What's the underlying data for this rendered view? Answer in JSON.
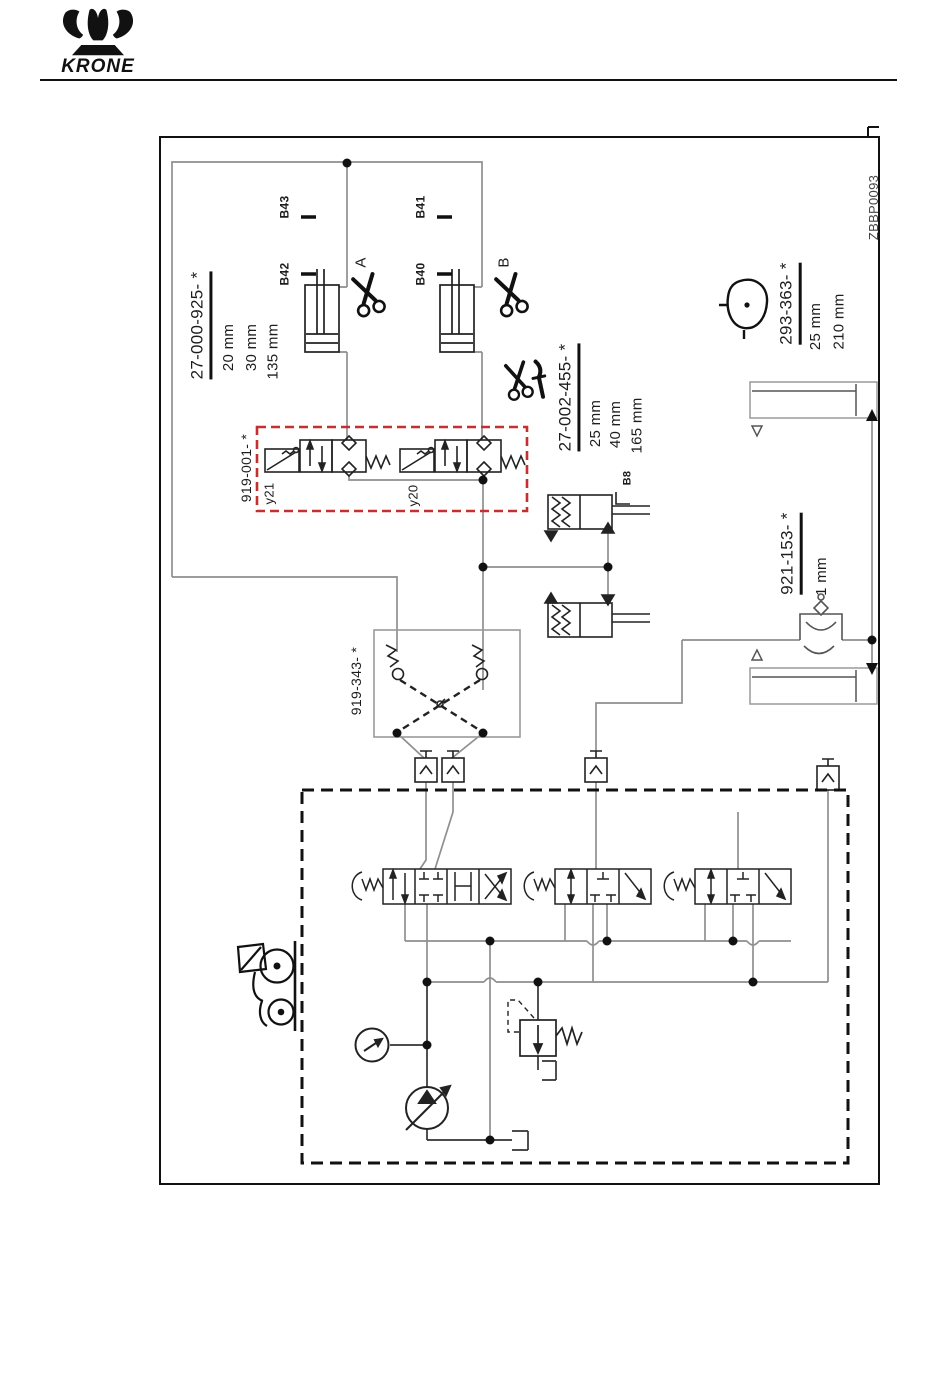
{
  "header": {
    "brand": "KRONE"
  },
  "diagram": {
    "drawing_number": "ZBBP0093",
    "parts": {
      "cylinders_front": {
        "label": "27-000-925- *",
        "dims": [
          "20 mm",
          "30 mm",
          "135 mm"
        ]
      },
      "solenoid_block": {
        "label": "919-001- *"
      },
      "knife_cylinders": {
        "label": "27-002-455- *",
        "dims": [
          "25 mm",
          "40 mm",
          "165 mm"
        ]
      },
      "pickup_cylinder": {
        "label": "293-363- *",
        "dims": [
          "25 mm",
          "210 mm"
        ]
      },
      "orifice": {
        "label": "921-153- *",
        "dims": [
          "1 mm"
        ]
      },
      "check_block": {
        "label": "919-343- *"
      }
    },
    "sensors": {
      "b43": "B43",
      "b42": "B42",
      "b41": "B41",
      "b40": "B40",
      "b8": "B8"
    },
    "solenoids": {
      "y21": "y21",
      "y20": "y20"
    },
    "ports": {
      "a": "A",
      "b": "B"
    },
    "colors": {
      "red": "#c43030",
      "gray": "#8f8f8f",
      "black": "#1d1d1d"
    }
  }
}
